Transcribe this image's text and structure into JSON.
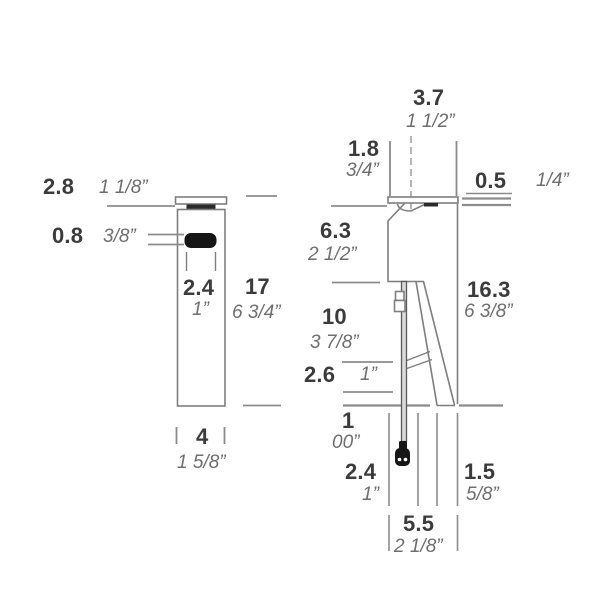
{
  "drawing": {
    "kind": "technical dimension drawing, front and side view of a bollard light fixture",
    "colors": {
      "background": "#ffffff",
      "outline": "#7e7e7e",
      "dimension_line": "#8b8b8b",
      "dark_fill": "#1d1d1d",
      "cm_text": "#3b3b3b",
      "inch_text": "#6e6e6e"
    }
  },
  "dims": {
    "front": {
      "top_gap": {
        "cm": "2.8",
        "inch": "1 1/8”"
      },
      "aperture_height": {
        "cm": "0.8",
        "inch": "3/8”"
      },
      "aperture_width": {
        "cm": "2.4",
        "inch": "1”"
      },
      "body_height": {
        "cm": "17",
        "inch": "6 3/4”"
      },
      "body_width": {
        "cm": "4",
        "inch": "1 5/8”"
      }
    },
    "side": {
      "head_depth": {
        "cm": "3.7",
        "inch": "1 1/2”"
      },
      "cap_overhang": {
        "cm": "1.8",
        "inch": "3/4”"
      },
      "cap_thickness": {
        "cm": "0.5",
        "inch": "1/4”"
      },
      "head_height": {
        "cm": "6.3",
        "inch": "2 1/2”"
      },
      "overall_height": {
        "cm": "16.3",
        "inch": "6 3/8”"
      },
      "stem_height": {
        "cm": "10",
        "inch": "3 7/8”"
      },
      "lower_gap": {
        "cm": "2.6",
        "inch": "1”"
      },
      "ground_clearance": {
        "cm": "1",
        "inch": "00”"
      },
      "base_front": {
        "cm": "2.4",
        "inch": "1”"
      },
      "base_back": {
        "cm": "1.5",
        "inch": "5/8”"
      },
      "base_total": {
        "cm": "5.5",
        "inch": "2 1/8”"
      }
    }
  }
}
